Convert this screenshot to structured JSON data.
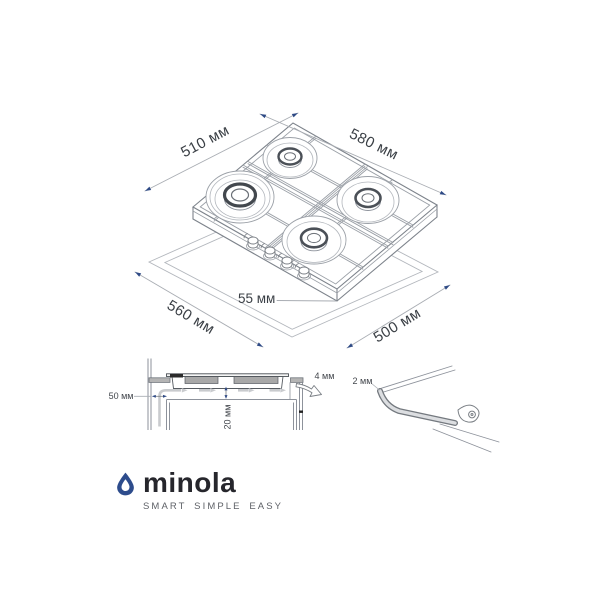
{
  "iso": {
    "dimensions": {
      "top_depth": "510 мм",
      "top_width": "580 мм",
      "cutout_width": "560 мм",
      "cutout_depth": "500 мм",
      "body_height": "55 мм"
    }
  },
  "section": {
    "dimensions": {
      "wall_clearance": "50 мм",
      "bottom_clearance": "20 мм",
      "front_gap": "4 мм"
    }
  },
  "seal": {
    "dimensions": {
      "seal_gap": "2 мм"
    }
  },
  "logo": {
    "brand": "minola",
    "tagline": "SMART SIMPLE EASY"
  },
  "colors": {
    "accent_blue": "#2d4c8c",
    "arrow_blue": "#2e4a85",
    "line_gray": "#8d929b",
    "dimension_text": "#3b4046"
  }
}
